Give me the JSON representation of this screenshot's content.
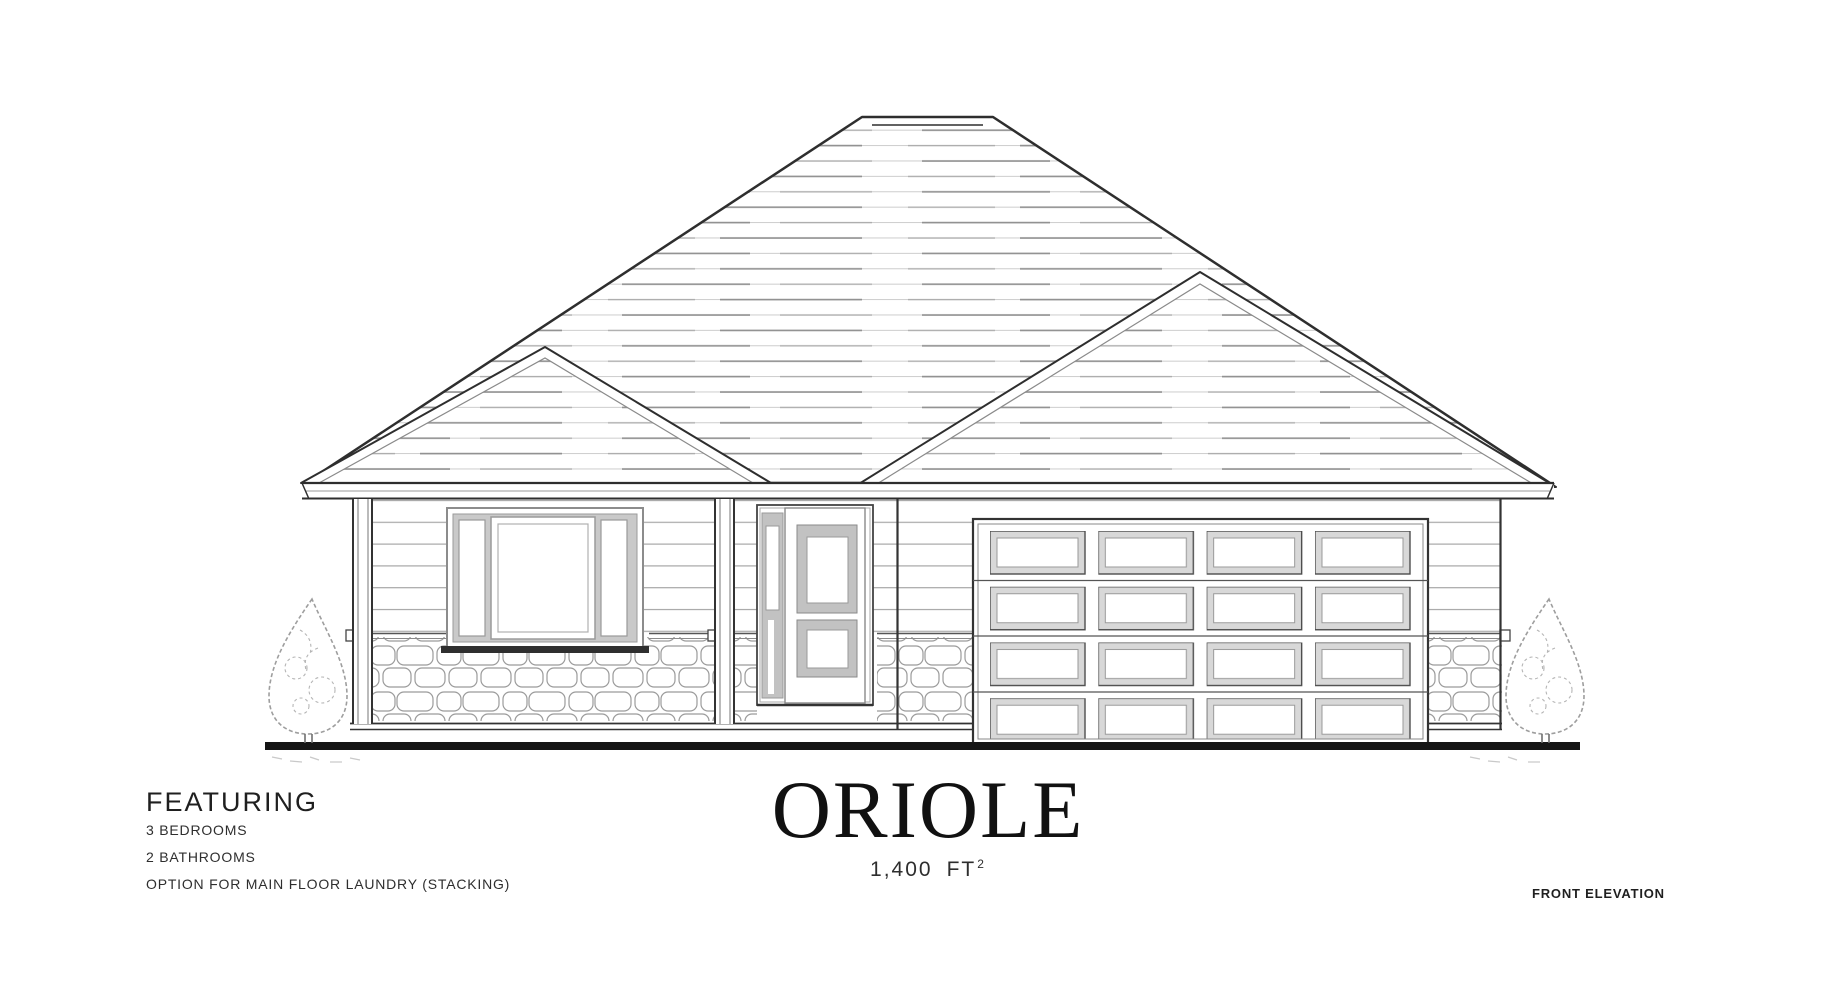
{
  "colors": {
    "paper": "#ffffff",
    "ink": "#1f1f1f",
    "muted": "#2e2e2e"
  },
  "featuring": {
    "heading": "FEATURING",
    "items": [
      "3 BEDROOMS",
      "2 BATHROOMS",
      "OPTION FOR MAIN FLOOR LAUNDRY (STACKING)"
    ]
  },
  "title": {
    "plan_name": "ORIOLE",
    "area_value": "1,400",
    "area_unit": "FT",
    "area_superscript": "2"
  },
  "annotation": {
    "drawing_label": "FRONT ELEVATION"
  }
}
